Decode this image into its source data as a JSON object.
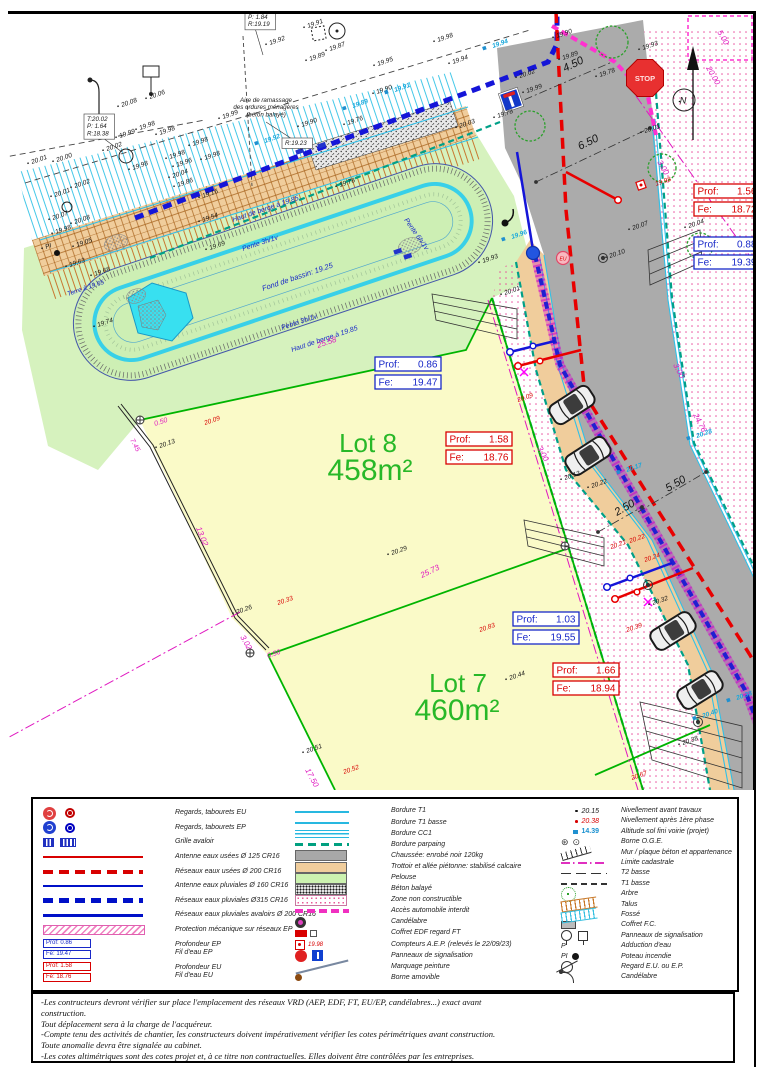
{
  "plan": {
    "colors": {
      "ep_blue": "#1828C8",
      "eu_red": "#D80000",
      "project_cyan": "#18A8DC",
      "magenta": "#E018C0",
      "lot_green": "#28B828",
      "road_gray": "#ABABAB",
      "sidewalk_tan": "#F0CD9C",
      "lawn_green": "#D6F2BE",
      "lot_yellow": "#FAFAC8",
      "water_cyan": "#38E0F0"
    },
    "signs": {
      "stop": "STOP"
    },
    "box_labels": {
      "prof": "Prof:",
      "fe": "Fe:"
    },
    "labels": [
      [
        "19.91",
        308,
        28
      ],
      [
        "19.98",
        438,
        42
      ],
      [
        "19.92",
        270,
        45
      ],
      [
        "19.87",
        330,
        51
      ],
      [
        "19.89",
        310,
        61
      ],
      [
        "19.95",
        378,
        66
      ],
      [
        "19.94",
        453,
        64
      ],
      [
        "19.90",
        377,
        94
      ],
      [
        "19.76",
        348,
        125
      ],
      [
        "19.90",
        302,
        127
      ],
      [
        "19.90",
        557,
        38
      ],
      [
        "19.93",
        643,
        50
      ],
      [
        "19.89",
        563,
        60
      ],
      [
        "19.78",
        600,
        77
      ],
      [
        "20.02",
        520,
        78
      ],
      [
        "19.99",
        527,
        93
      ],
      [
        "19.78",
        498,
        118
      ],
      [
        "20.01",
        645,
        133
      ],
      [
        "20.04",
        689,
        228
      ],
      [
        "20.08",
        122,
        107
      ],
      [
        "20.06",
        150,
        99
      ],
      [
        "19.98",
        140,
        130
      ],
      [
        "19.99",
        120,
        138
      ],
      [
        "20.02",
        107,
        151
      ],
      [
        "20.00",
        57,
        162
      ],
      [
        "20.01",
        32,
        164
      ],
      [
        "19.98",
        193,
        146
      ],
      [
        "19.99",
        223,
        119
      ],
      [
        "19.98",
        160,
        135
      ],
      [
        "19.98",
        170,
        159
      ],
      [
        "19.98",
        205,
        160
      ],
      [
        "19.98",
        133,
        170
      ],
      [
        "20.04",
        173,
        178
      ],
      [
        "19.86",
        178,
        187
      ],
      [
        "19.16",
        203,
        198
      ],
      [
        "20.02",
        75,
        188
      ],
      [
        "20.01",
        55,
        197
      ],
      [
        "20.07",
        53,
        220
      ],
      [
        "20.08",
        75,
        224
      ],
      [
        "19.98",
        56,
        234
      ],
      [
        "19.05",
        77,
        247
      ],
      [
        "19.63",
        70,
        267
      ],
      [
        "19.68",
        95,
        276
      ],
      [
        "19.74",
        98,
        327
      ],
      [
        "19.54",
        203,
        222
      ],
      [
        "19.69",
        210,
        250
      ],
      [
        "19.78",
        340,
        187
      ],
      [
        "20.03",
        460,
        128
      ],
      [
        "19.93",
        483,
        263
      ],
      [
        "20.01",
        505,
        295
      ],
      [
        "20.10",
        610,
        258
      ],
      [
        "20.07",
        633,
        230
      ],
      [
        "20.13",
        160,
        448
      ],
      [
        "20.26",
        237,
        614
      ],
      [
        "20.29",
        392,
        555
      ],
      [
        "20.44",
        510,
        680
      ],
      [
        "20.51",
        307,
        753
      ],
      [
        "20.13",
        565,
        480
      ],
      [
        "20.22",
        592,
        488
      ],
      [
        "20.32",
        653,
        605
      ],
      [
        "20.38",
        683,
        745
      ],
      [
        "19.96",
        177,
        167
      ],
      [
        "PI",
        46,
        249
      ],
      [
        "20.09",
        205,
        425,
        "r"
      ],
      [
        "20.33",
        278,
        605,
        "r"
      ],
      [
        "20.52",
        344,
        774,
        "r"
      ],
      [
        "20.83",
        480,
        632,
        "r"
      ],
      [
        "20.09",
        518,
        402,
        "r"
      ],
      [
        "20.22",
        630,
        543,
        "r"
      ],
      [
        "20.21",
        611,
        549,
        "r"
      ],
      [
        "20.24",
        645,
        562,
        "r"
      ],
      [
        "20.39",
        627,
        632,
        "r"
      ],
      [
        "20.67",
        632,
        780,
        "r"
      ],
      [
        "19.98",
        656,
        186,
        "r"
      ],
      [
        "19.94",
        493,
        48,
        "c"
      ],
      [
        "19.91",
        395,
        92,
        "c"
      ],
      [
        "19.89",
        353,
        108,
        "c"
      ],
      [
        "19.92",
        265,
        143,
        "c"
      ],
      [
        "19.96",
        512,
        239,
        "c"
      ],
      [
        "20.17",
        627,
        472,
        "c"
      ],
      [
        "20.28",
        697,
        438,
        "c"
      ],
      [
        "20.38",
        737,
        700,
        "c"
      ],
      [
        "20.40",
        703,
        718,
        "c"
      ],
      [
        "Haut de berge à 19.85",
        233,
        222,
        "b",
        -18.6,
        7
      ],
      [
        "Pente 3h/1v",
        243,
        251,
        "b",
        -18.6,
        7
      ],
      [
        "Fond de bassin: 19.25",
        263,
        291,
        "b",
        -18.6,
        7.5
      ],
      [
        "Pente 3h/1v",
        282,
        330,
        "b",
        -18.6,
        7
      ],
      [
        "Haut de berge à 19.85",
        292,
        352,
        "b",
        -18.6,
        7
      ],
      [
        "Pente 6h/1v",
        404,
        220,
        "b",
        55,
        7
      ],
      [
        "Terre à 19.65",
        68,
        296,
        "b",
        -18.6,
        6.5
      ],
      [
        "5.00",
        717,
        32,
        "m",
        60,
        8
      ],
      [
        "20.00",
        706,
        68,
        "m",
        60,
        8
      ],
      [
        "3.00",
        657,
        162,
        "m",
        60,
        8
      ],
      [
        "3.00",
        537,
        448,
        "m",
        62,
        8
      ],
      [
        "3.00",
        673,
        365,
        "m",
        62,
        8
      ],
      [
        "24.76",
        693,
        415,
        "m",
        62,
        8
      ],
      [
        "25.58",
        318,
        348,
        "m",
        -19,
        8
      ],
      [
        "25.73",
        422,
        578,
        "m",
        -26,
        8
      ],
      [
        "13.02",
        196,
        528,
        "m",
        68,
        8
      ],
      [
        "3.02",
        240,
        637,
        "m",
        60,
        8
      ],
      [
        "0.50",
        155,
        426,
        "m",
        -19,
        7
      ],
      [
        "0.50",
        268,
        658,
        "m",
        -19,
        7
      ],
      [
        "7.45",
        130,
        440,
        "m",
        62,
        7
      ],
      [
        "17.50",
        305,
        770,
        "m",
        62,
        8
      ],
      [
        "6.50",
        580,
        150,
        "d",
        -26,
        11
      ],
      [
        "4.50",
        565,
        72,
        "d",
        -26,
        11
      ],
      [
        "2.50",
        617,
        516,
        "d",
        -30,
        11
      ],
      [
        "5.50",
        668,
        492,
        "d",
        -30,
        11
      ],
      [
        "Lot 8",
        368,
        452,
        "g",
        0,
        26,
        "m"
      ],
      [
        "458m²",
        370,
        480,
        "g",
        0,
        30,
        "m"
      ],
      [
        "Lot 7",
        458,
        692,
        "g",
        0,
        26,
        "m"
      ],
      [
        "460m²",
        457,
        720,
        "g",
        0,
        30,
        "m"
      ],
      [
        "EU",
        563,
        260.5,
        "r",
        0,
        5,
        "m"
      ],
      [
        "N",
        683,
        103.5,
        "k",
        0,
        9,
        "m"
      ]
    ],
    "info_boxes": [
      {
        "x": 84,
        "y": 114,
        "lines": [
          "T:20.02",
          "P: 1.64",
          "R:18.38"
        ]
      },
      {
        "x": 245,
        "y": 12,
        "lines": [
          "P: 1.84",
          "R:19.19"
        ]
      },
      {
        "x": 282,
        "y": 138,
        "lines": [
          "R:19.23"
        ]
      }
    ],
    "aire_note": {
      "x": 266,
      "y": 102,
      "lines": [
        "Aire de ramassage",
        "des ordures ménagères",
        "(béton balayé)"
      ]
    },
    "prof_boxes": [
      {
        "x": 375,
        "y": 357,
        "t": "ep",
        "prof": "0.86",
        "fe": "19.47"
      },
      {
        "x": 446,
        "y": 432,
        "t": "eu",
        "prof": "1.58",
        "fe": "18.76"
      },
      {
        "x": 513,
        "y": 612,
        "t": "ep",
        "prof": "1.03",
        "fe": "19.55"
      },
      {
        "x": 553,
        "y": 663,
        "t": "eu",
        "prof": "1.66",
        "fe": "18.94"
      },
      {
        "x": 694,
        "y": 184,
        "t": "eu",
        "prof": "1.56",
        "fe": "18.72"
      },
      {
        "x": 694,
        "y": 237,
        "t": "ep",
        "prof": "0.88",
        "fe": "19.39"
      }
    ]
  },
  "legend": {
    "col1": [
      {
        "sym": "regard-eu",
        "label": "Regards, tabourets   EU"
      },
      {
        "sym": "regard-ep",
        "label": "Regards, tabourets   EP"
      },
      {
        "sym": "grille",
        "label": "Grille avaloir"
      },
      {
        "sym": "line-red",
        "label": "Antenne eaux usées Ø 125 CR16"
      },
      {
        "sym": "dash-red",
        "label": "Réseaux eaux usées Ø 200 CR16"
      },
      {
        "sym": "line-blue",
        "label": "Antenne eaux pluviales Ø 160 CR16"
      },
      {
        "sym": "dash-blue",
        "label": "Réseaux  eaux  pluviales  Ø315 CR16"
      },
      {
        "sym": "line-blue2",
        "label": "Réseaux  eaux pluviales avaloirs Ø 200 CR16"
      },
      {
        "sym": "hatch-pink",
        "label": "Protection mécanique sur réseaux EP"
      },
      {
        "sym": "box-ep",
        "v1": "Prof:  0.86",
        "v2": "Fe:  19.47",
        "label": "Profondeur EP",
        "label2": "Fil d'eau EP"
      },
      {
        "sym": "box-eu",
        "v1": "Prof:  1.58",
        "v2": "Fe:  18.76",
        "label": "Profondeur EU",
        "label2": "Fil d'eau EU"
      }
    ],
    "col2": [
      {
        "sym": "line-cyan",
        "label": "Bordure T1"
      },
      {
        "sym": "line-cyan",
        "label": "Bordure T1 basse"
      },
      {
        "sym": "line-cc1",
        "label": "Bordure CC1"
      },
      {
        "sym": "dash-teal",
        "label": "Bordure parpaing"
      },
      {
        "sym": "sw-gray",
        "label": "Chaussée: enrobé noir 120kg"
      },
      {
        "sym": "sw-tan",
        "label": "Trottoir et allée piétonne: stabilisé calcaire"
      },
      {
        "sym": "sw-green",
        "label": "Pelouse"
      },
      {
        "sym": "sw-beton",
        "label": "Béton balayé"
      },
      {
        "sym": "sw-zone",
        "label": "Zone non constructible"
      },
      {
        "sym": "dash-mag",
        "label": "Accès automobile interdit"
      },
      {
        "sym": "candelabre",
        "label": "Candélabre"
      },
      {
        "sym": "coffret",
        "label": "Coffret EDF regard FT"
      },
      {
        "sym": "compteur",
        "v": "19.98",
        "label": "Compteurs A.E.P. (relevés le 22/09/23)"
      },
      {
        "sym": "panneaux",
        "label": "Panneaux de signalisation"
      },
      {
        "sym": "marquage",
        "label": "Marquage peinture"
      },
      {
        "sym": "borne-am",
        "label": "Borne amovible"
      }
    ],
    "col3": [
      {
        "sym": "pt-k",
        "v": "20.15",
        "label": "Nivellement avant travaux"
      },
      {
        "sym": "pt-r",
        "v": "20.38",
        "label": "Nivellement après 1ère phase"
      },
      {
        "sym": "pt-c",
        "v": "14.39",
        "label": "Altitude sol fini voirie (projet)"
      },
      {
        "sym": "oge",
        "label": "Borne O.G.E."
      },
      {
        "sym": "mur",
        "label": "Mur / plaque béton et appartenance"
      },
      {
        "sym": "limite",
        "label": "Limite cadastrale"
      },
      {
        "sym": "t2",
        "label": "T2 basse"
      },
      {
        "sym": "t1",
        "label": "T1 basse"
      },
      {
        "sym": "arbre",
        "label": "Arbre"
      },
      {
        "sym": "talus",
        "label": "Talus"
      },
      {
        "sym": "fosse",
        "label": "Fossé"
      },
      {
        "sym": "coffret-fc",
        "label": "Coffret F.C."
      },
      {
        "sym": "panneaux2",
        "label": "Panneaux de signalisation"
      },
      {
        "sym": "addu",
        "v": "P",
        "label": "Adduction d'eau"
      },
      {
        "sym": "pi",
        "v": "PI",
        "label": "Poteau incendie"
      },
      {
        "sym": "regard",
        "label": "Regard E.U. ou E.P."
      },
      {
        "sym": "cand2",
        "label": "Candélabre"
      }
    ]
  },
  "notes": {
    "lines": [
      "-Les contructeurs devront vérifier sur place l'emplacement des réseaux VRD (AEP, EDF, FT, EU/EP, candélabres...) exact avant",
      "construction.",
      "Tout déplacement sera à la charge de l'acquéreur.",
      "-Compte tenu des activités de chantier, les constructeurs doivent impérativement vérifier les cotes périmétriques avant construction.",
      "Toute anomalie devra être signalée au cabinet.",
      "-Les cotes altimétriques sont des cotes projet et, à ce titre non contractuelles. Elles doivent être contrôlées par les entreprises."
    ]
  }
}
